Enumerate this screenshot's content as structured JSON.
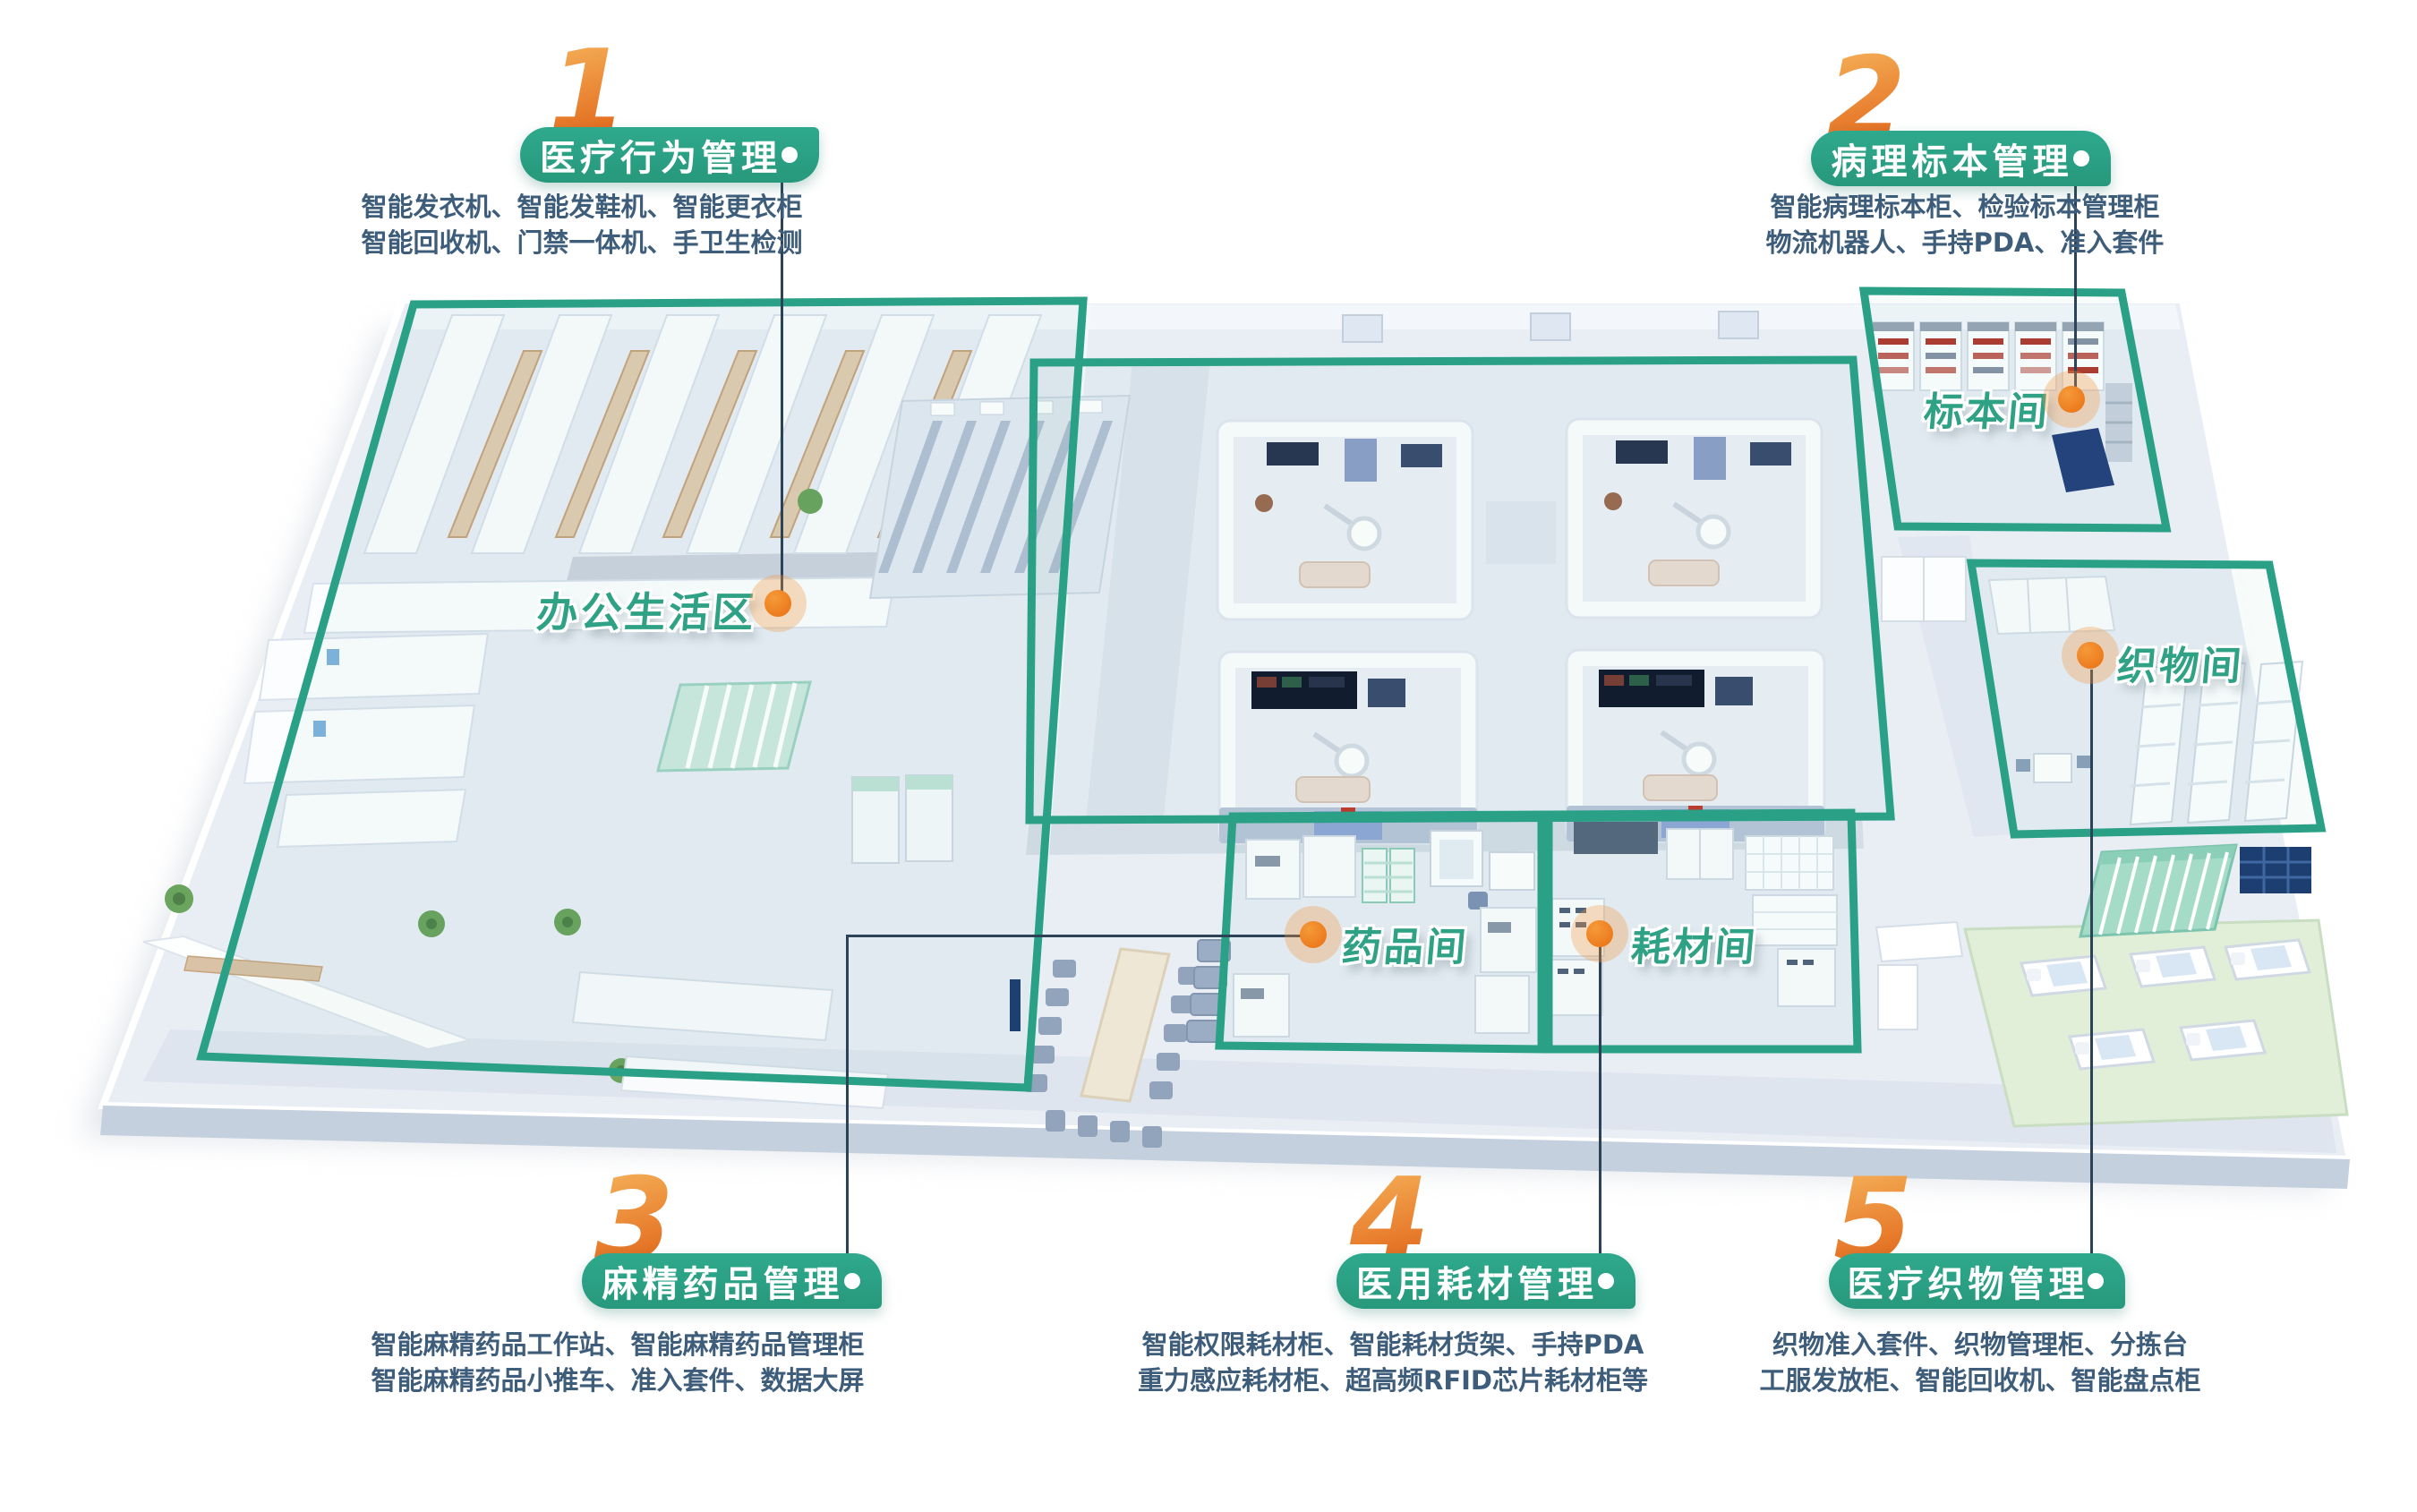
{
  "callouts": [
    {
      "number": "1",
      "title": "医疗行为管理",
      "desc1": "智能发衣机、智能发鞋机、智能更衣柜",
      "desc2": "智能回收机、门禁一体机、手卫生检测"
    },
    {
      "number": "2",
      "title": "病理标本管理",
      "desc1": "智能病理标本柜、检验标本管理柜",
      "desc2": "物流机器人、手持PDA、准入套件"
    },
    {
      "number": "3",
      "title": "麻精药品管理",
      "desc1": "智能麻精药品工作站、智能麻精药品管理柜",
      "desc2": "智能麻精药品小推车、准入套件、数据大屏"
    },
    {
      "number": "4",
      "title": "医用耗材管理",
      "desc1": "智能权限耗材柜、智能耗材货架、手持PDA",
      "desc2": "重力感应耗材柜、超高频RFID芯片耗材柜等"
    },
    {
      "number": "5",
      "title": "医疗织物管理",
      "desc1": "织物准入套件、织物管理柜、分拣台",
      "desc2": "工服发放柜、智能回收机、智能盘点柜"
    }
  ],
  "rooms": {
    "office": "办公生活区",
    "specimen": "标本间",
    "textile": "织物间",
    "drug": "药品间",
    "consumable": "耗材间"
  },
  "colors": {
    "zone_green": "#2aa187",
    "marker_orange": "#ee7d18",
    "number_orange": "#e8782b",
    "connector": "#2c4257",
    "desc_text": "#3e5d7b"
  }
}
